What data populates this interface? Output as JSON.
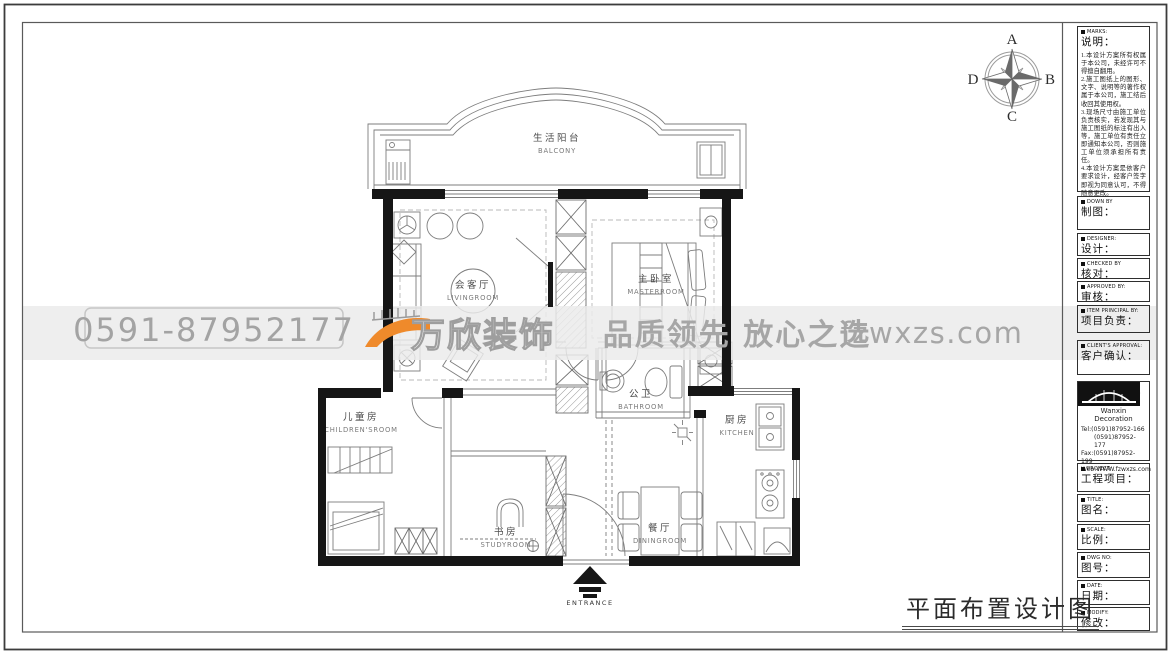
{
  "footer": {
    "title": "平面布置设计图"
  },
  "compass": {
    "n": "A",
    "e": "B",
    "s": "C",
    "w": "D"
  },
  "watermark": {
    "phone": "0591-87952177",
    "brand": "万欣装饰",
    "slogan": "品质领先 放心之选",
    "site": "fzwxzs.com",
    "accent_orange": "#ef8a2b",
    "gray": "#a6a6a6"
  },
  "rooms": {
    "balcony": {
      "cn": "生活阳台",
      "en": "BALCONY"
    },
    "living": {
      "cn": "会客厅",
      "en": "LIVINGROOM"
    },
    "master": {
      "cn": "主卧室",
      "en": "MASTERROOM"
    },
    "children": {
      "cn": "儿童房",
      "en": "CHILDREN'SROOM"
    },
    "bathroom": {
      "cn": "公卫",
      "en": "BATHROOM"
    },
    "kitchen": {
      "cn": "厨房",
      "en": "KITCHEN"
    },
    "study": {
      "cn": "书房",
      "en": "STUDYROOM"
    },
    "dining": {
      "cn": "餐厅",
      "en": "DININGROOM"
    },
    "entrance": {
      "en": "ENTRANCE"
    }
  },
  "titleblock": {
    "notes": {
      "en": "MARKS:",
      "cn": "说明：",
      "body": "1.本设计方案所有权属于本公司，未经许可不得擅自翻用。\n2.施工图纸上的图形、文字、说明等的著作权属于本公司，施工结后收回其使用权。\n3.现场尺寸由施工单位负责核实，若发现其与施工图纸的标注有出入等，施工单位有责任立即通知本公司，否则施工单位须承担所有责任。\n4.本设计方案是依客户要求设计，经客户签字即视为同意认可，不得随意更改。"
    },
    "fields": [
      {
        "en": "DOWN BY",
        "cn": "制图："
      },
      {
        "en": "DESIGNER:",
        "cn": "设计："
      },
      {
        "en": "CHECKED BY",
        "cn": "核对："
      },
      {
        "en": "APPROVED BY:",
        "cn": "审核："
      },
      {
        "en": "ITEM PRINCIPAL BY:",
        "cn": "项目负责："
      },
      {
        "en": "CLIENT'S APPROVAL:",
        "cn": "客户确认："
      }
    ],
    "company": {
      "logo_cn": "万欣装饰",
      "logo_en": "Wanxin Decoration",
      "tel1": "Tel:(0591)87952-166",
      "tel2": "(0591)87952-177",
      "fax": "Fax:(0591)87952-199",
      "web": "Web:WWW.fzwxzs.com"
    },
    "fields2": [
      {
        "en": "PROJECT:",
        "cn": "工程项目："
      },
      {
        "en": "TITLE:",
        "cn": "图名："
      },
      {
        "en": "SCALE:",
        "cn": "比例："
      },
      {
        "en": "DWG NO:",
        "cn": "图号："
      },
      {
        "en": "DATE:",
        "cn": "日期："
      },
      {
        "en": "MODIFY:",
        "cn": "修改："
      }
    ]
  }
}
